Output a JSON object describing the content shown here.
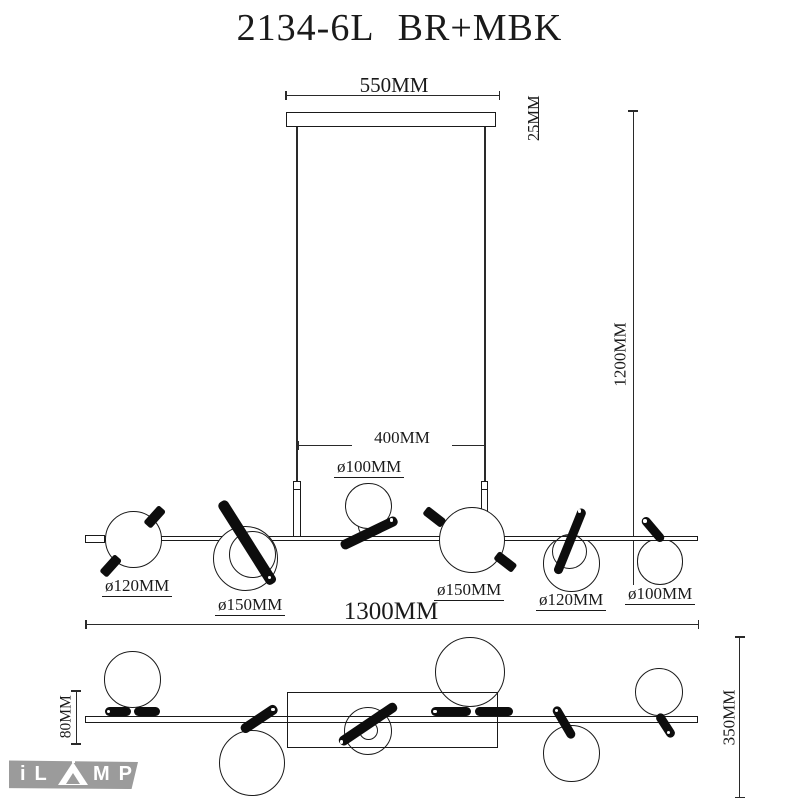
{
  "title": "2134-6L BR+MBK",
  "front_view": {
    "canopy_width": "550MM",
    "canopy_thickness": "25MM",
    "drop_height": "1200MM",
    "cord_spacing": "400MM",
    "shade_top": "ø100MM",
    "shade_1": "ø120MM",
    "shade_2": "ø150MM",
    "shade_4": "ø150MM",
    "shade_5": "ø120MM",
    "shade_6": "ø100MM"
  },
  "plan_view": {
    "total_length": "1300MM",
    "bar_offset": "80MM",
    "depth": "350MM"
  },
  "logo": {
    "part1": "iL",
    "part2": "MP"
  },
  "colors": {
    "ink": "#1a1a1a",
    "logo_gray": "#9b9b9b",
    "background": "#ffffff"
  }
}
